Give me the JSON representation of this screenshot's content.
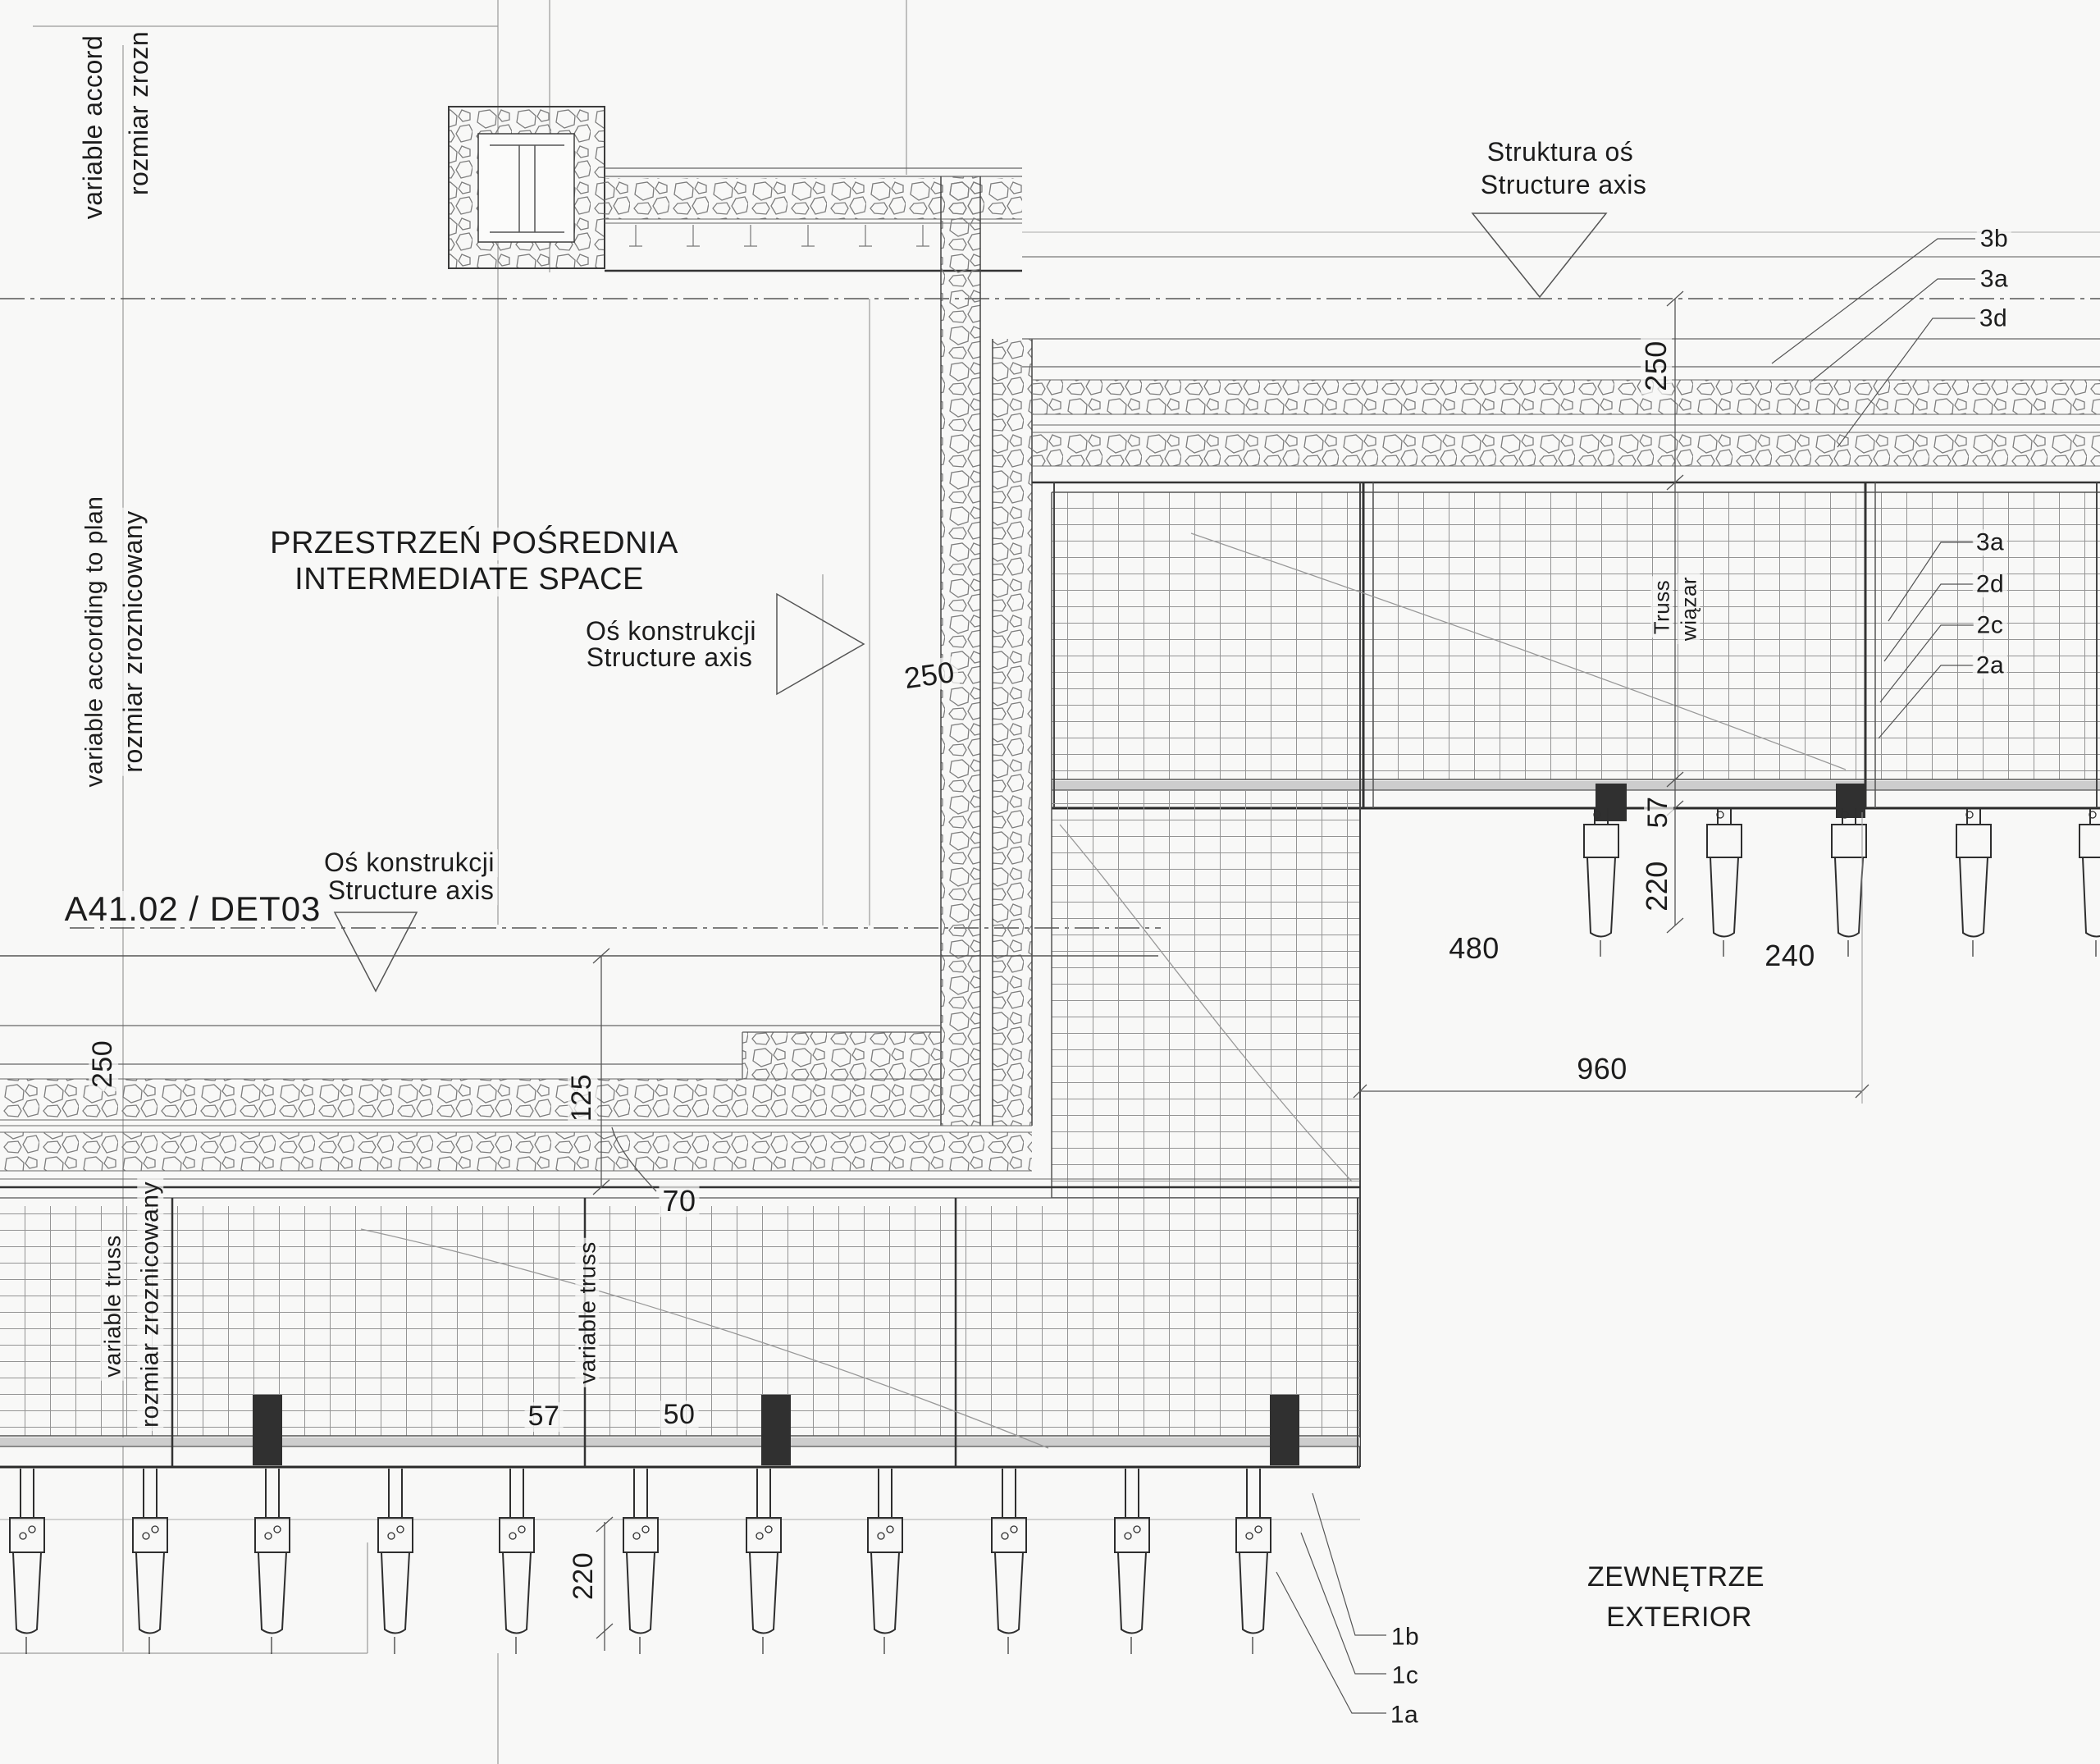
{
  "detail": {
    "code": "A41.02 / DET03"
  },
  "zones": {
    "intermediate_pl": "PRZESTRZEŃ POŚREDNIA",
    "intermediate_en": "INTERMEDIATE SPACE",
    "exterior_pl": "ZEWNĘTRZE",
    "exterior_en": "EXTERIOR"
  },
  "axes": {
    "top_pl": "Struktura oś",
    "top_en": "Structure axis",
    "corner_pl": "Oś konstrukcji",
    "corner_en": "Structure axis",
    "lower_pl": "Oś konstrukcji",
    "lower_en": "Structure axis"
  },
  "notes": {
    "top_left_en": "variable accord",
    "top_left_pl": "rozmiar zrozn",
    "mid_left_en": "variable according to plan",
    "mid_left_pl": "rozmiar zroznicowany",
    "left_truss_en": "variable truss",
    "left_truss_pl": "rozmiar zroznicowany",
    "mid_truss": "variable truss",
    "right_truss_en": "Truss",
    "right_truss_pl": "wiązar"
  },
  "dimensions": {
    "top_right_offset": "250",
    "corner_offset": "250",
    "left_wall_offset": "250",
    "right_chord": "57",
    "right_anchor_len": "220",
    "bay_480": "480",
    "bay_240": "240",
    "bay_960": "960",
    "wall_125": "125",
    "layer_70": "70",
    "member_57": "57",
    "member_50": "50",
    "left_anchor_len": "220"
  },
  "callouts": {
    "upper": [
      "3b",
      "3a",
      "3d"
    ],
    "middle": [
      "3a",
      "2d",
      "2c",
      "2a"
    ],
    "lower": [
      "1b",
      "1c",
      "1a"
    ]
  },
  "colors": {
    "background": "#f8f8f7",
    "line": "#4a4a4a",
    "line_heavy": "#2a2a2a",
    "hatch": "#787878",
    "grid": "#949494",
    "chord_fill": "#cdcdcd",
    "text": "#1c1c1c"
  }
}
